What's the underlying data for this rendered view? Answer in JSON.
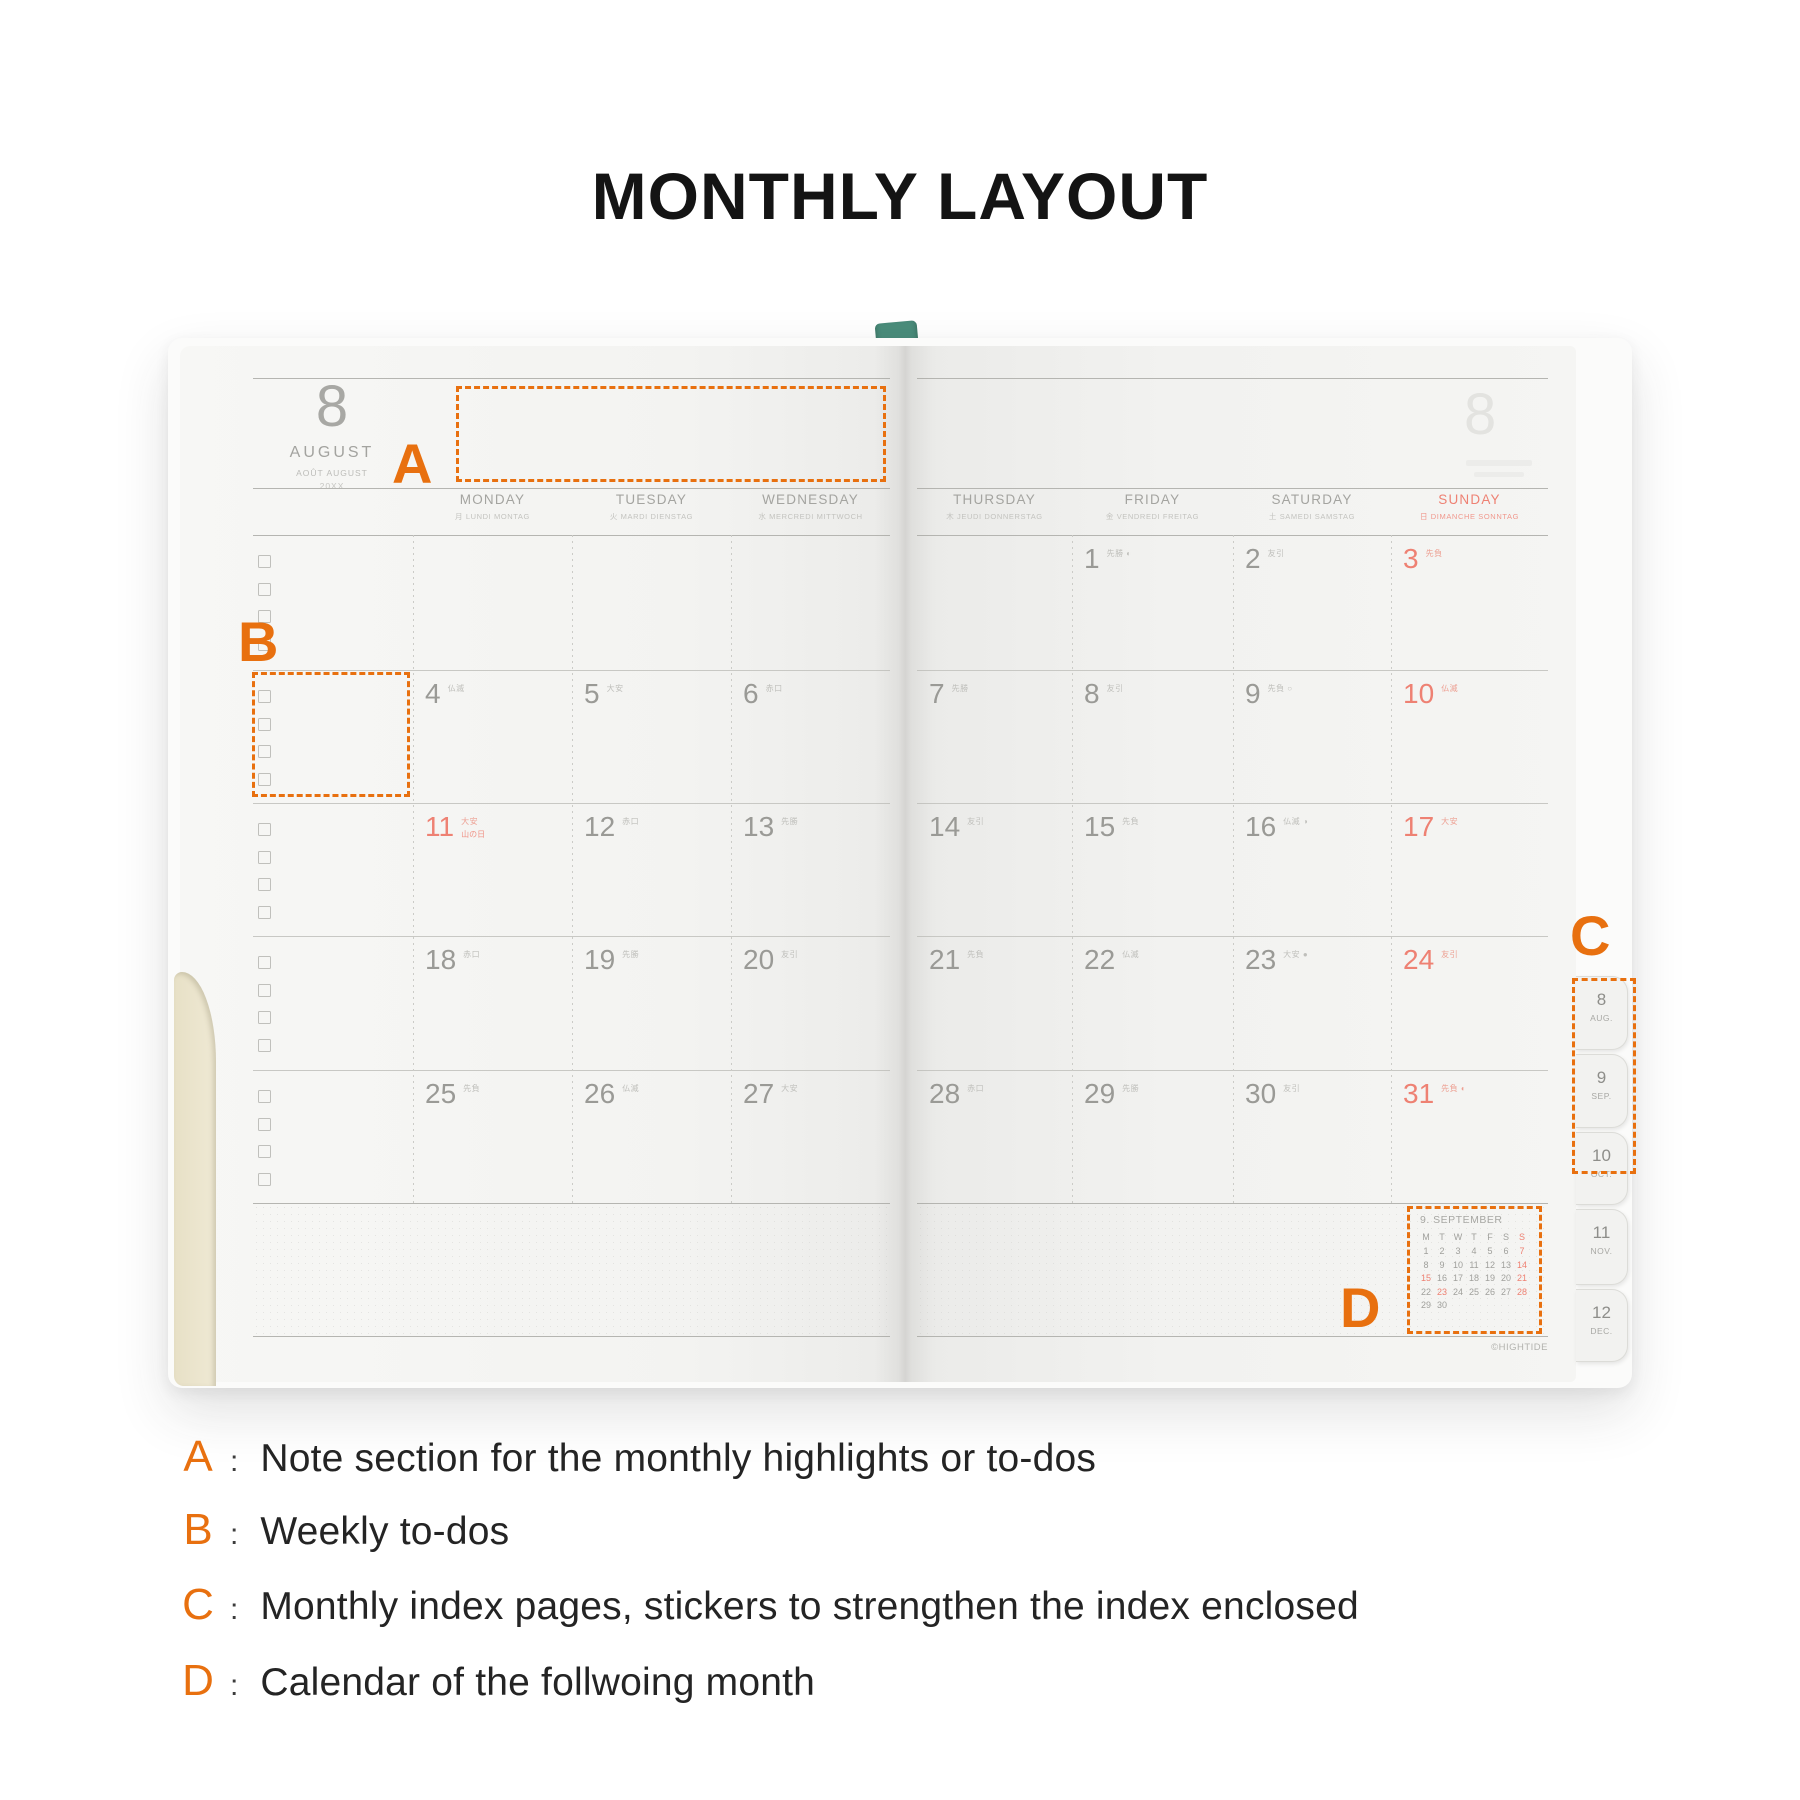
{
  "page": {
    "title": "MONTHLY LAYOUT"
  },
  "legend": {
    "separator": ":",
    "items": [
      {
        "letter": "A",
        "text": "Note section for the monthly highlights or to-dos"
      },
      {
        "letter": "B",
        "text": "Weekly to-dos"
      },
      {
        "letter": "C",
        "text": "Monthly index pages, stickers to strengthen the index enclosed"
      },
      {
        "letter": "D",
        "text": "Calendar of the follwoing month"
      }
    ]
  },
  "overlay": {
    "a": "A",
    "b": "B",
    "c": "C",
    "d": "D"
  },
  "colors": {
    "accent_orange": "#e8700f",
    "holiday_red": "#ee8173",
    "ink_gray": "#9a9a96",
    "bookmark_teal": "#4a8d7b"
  },
  "planner": {
    "brand": "©HIGHTIDE",
    "month": {
      "number": "8",
      "name": "AUGUST",
      "subtitle": "AOÛT AUGUST",
      "year": "20XX",
      "ghost_number": "8"
    },
    "day_headers": [
      {
        "name": "MONDAY",
        "sub": "月 LUNDI MONTAG",
        "red": false
      },
      {
        "name": "TUESDAY",
        "sub": "火 MARDI DIENSTAG",
        "red": false
      },
      {
        "name": "WEDNESDAY",
        "sub": "水 MERCREDI MITTWOCH",
        "red": false
      },
      {
        "name": "THURSDAY",
        "sub": "木 JEUDI DONNERSTAG",
        "red": false
      },
      {
        "name": "FRIDAY",
        "sub": "金 VENDREDI FREITAG",
        "red": false
      },
      {
        "name": "SATURDAY",
        "sub": "土 SAMEDI SAMSTAG",
        "red": false
      },
      {
        "name": "SUNDAY",
        "sub": "日 DIMANCHE SONNTAG",
        "red": true
      }
    ],
    "weeks": [
      {
        "cells": [
          null,
          null,
          null,
          null,
          {
            "day": "1",
            "note": "先勝",
            "moon": "◐"
          },
          {
            "day": "2",
            "note": "友引"
          },
          {
            "day": "3",
            "note": "先負",
            "red": true
          }
        ]
      },
      {
        "cells": [
          {
            "day": "4",
            "note": "仏滅"
          },
          {
            "day": "5",
            "note": "大安"
          },
          {
            "day": "6",
            "note": "赤口"
          },
          {
            "day": "7",
            "note": "先勝"
          },
          {
            "day": "8",
            "note": "友引"
          },
          {
            "day": "9",
            "note": "先負",
            "moon": "○"
          },
          {
            "day": "10",
            "note": "仏滅",
            "red": true
          }
        ]
      },
      {
        "cells": [
          {
            "day": "11",
            "note": "大安",
            "holiday": "山の日",
            "red": true
          },
          {
            "day": "12",
            "note": "赤口"
          },
          {
            "day": "13",
            "note": "先勝"
          },
          {
            "day": "14",
            "note": "友引"
          },
          {
            "day": "15",
            "note": "先負"
          },
          {
            "day": "16",
            "note": "仏滅",
            "moon": "◑"
          },
          {
            "day": "17",
            "note": "大安",
            "red": true
          }
        ]
      },
      {
        "cells": [
          {
            "day": "18",
            "note": "赤口"
          },
          {
            "day": "19",
            "note": "先勝"
          },
          {
            "day": "20",
            "note": "友引"
          },
          {
            "day": "21",
            "note": "先負"
          },
          {
            "day": "22",
            "note": "仏滅"
          },
          {
            "day": "23",
            "note": "大安",
            "moon": "●"
          },
          {
            "day": "24",
            "note": "友引",
            "red": true
          }
        ]
      },
      {
        "cells": [
          {
            "day": "25",
            "note": "先負"
          },
          {
            "day": "26",
            "note": "仏滅"
          },
          {
            "day": "27",
            "note": "大安"
          },
          {
            "day": "28",
            "note": "赤口"
          },
          {
            "day": "29",
            "note": "先勝"
          },
          {
            "day": "30",
            "note": "友引"
          },
          {
            "day": "31",
            "note": "先負",
            "moon": "◐",
            "red": true
          }
        ]
      }
    ],
    "tabs": [
      {
        "number": "8",
        "label": "AUG."
      },
      {
        "number": "9",
        "label": "SEP."
      },
      {
        "number": "10",
        "label": "OCT."
      },
      {
        "number": "11",
        "label": "NOV."
      },
      {
        "number": "12",
        "label": "DEC."
      }
    ],
    "mini_calendar": {
      "title": "9. SEPTEMBER",
      "headers": [
        {
          "t": "M"
        },
        {
          "t": "T"
        },
        {
          "t": "W"
        },
        {
          "t": "T"
        },
        {
          "t": "F"
        },
        {
          "t": "S"
        },
        {
          "t": "S",
          "red": true
        }
      ],
      "rows": [
        [
          {
            "t": "1"
          },
          {
            "t": "2"
          },
          {
            "t": "3"
          },
          {
            "t": "4"
          },
          {
            "t": "5"
          },
          {
            "t": "6"
          },
          {
            "t": "7",
            "red": true
          }
        ],
        [
          {
            "t": "8"
          },
          {
            "t": "9"
          },
          {
            "t": "10"
          },
          {
            "t": "11"
          },
          {
            "t": "12"
          },
          {
            "t": "13"
          },
          {
            "t": "14",
            "red": true
          }
        ],
        [
          {
            "t": "15",
            "red": true
          },
          {
            "t": "16"
          },
          {
            "t": "17"
          },
          {
            "t": "18"
          },
          {
            "t": "19"
          },
          {
            "t": "20"
          },
          {
            "t": "21",
            "red": true
          }
        ],
        [
          {
            "t": "22"
          },
          {
            "t": "23",
            "red": true
          },
          {
            "t": "24"
          },
          {
            "t": "25"
          },
          {
            "t": "26"
          },
          {
            "t": "27"
          },
          {
            "t": "28",
            "red": true
          }
        ],
        [
          {
            "t": "29"
          },
          {
            "t": "30"
          }
        ]
      ]
    }
  }
}
